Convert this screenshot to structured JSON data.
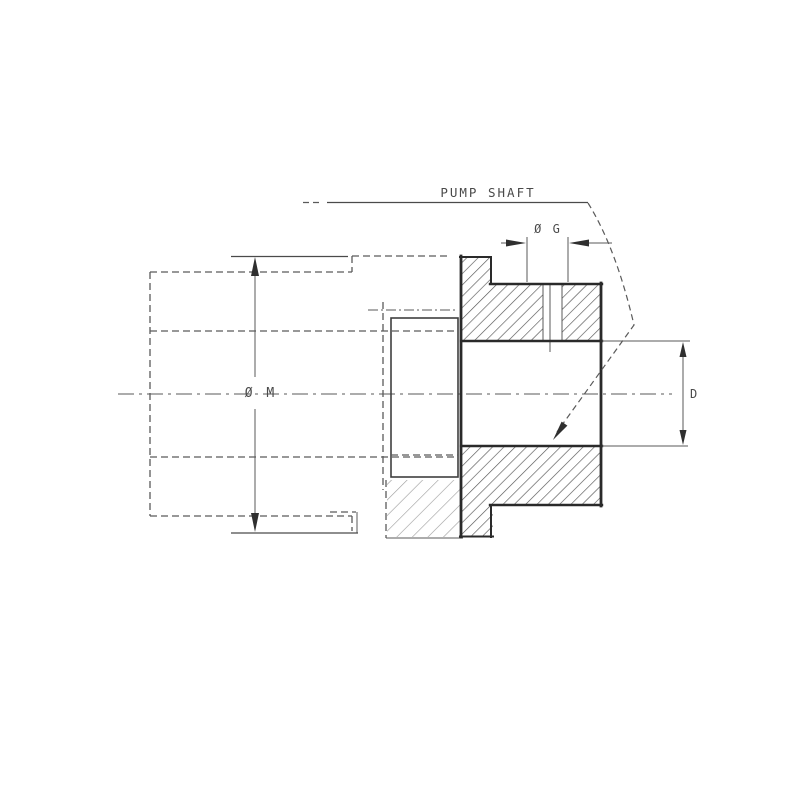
{
  "page": {
    "background": "#ffffff"
  },
  "drawing": {
    "type": "engineering-section-drawing",
    "labels": {
      "pump_shaft": "PUMP SHAFT",
      "dia_g": "Ø G",
      "dia_m": "Ø M",
      "d": "D"
    },
    "colors": {
      "outline": "#2a2a2a",
      "thin_line": "#5a5a5a",
      "hatch_dark": "#555555",
      "hatch_light": "#9a9a9a",
      "text": "#4a4a4a",
      "background": "#ffffff"
    }
  }
}
